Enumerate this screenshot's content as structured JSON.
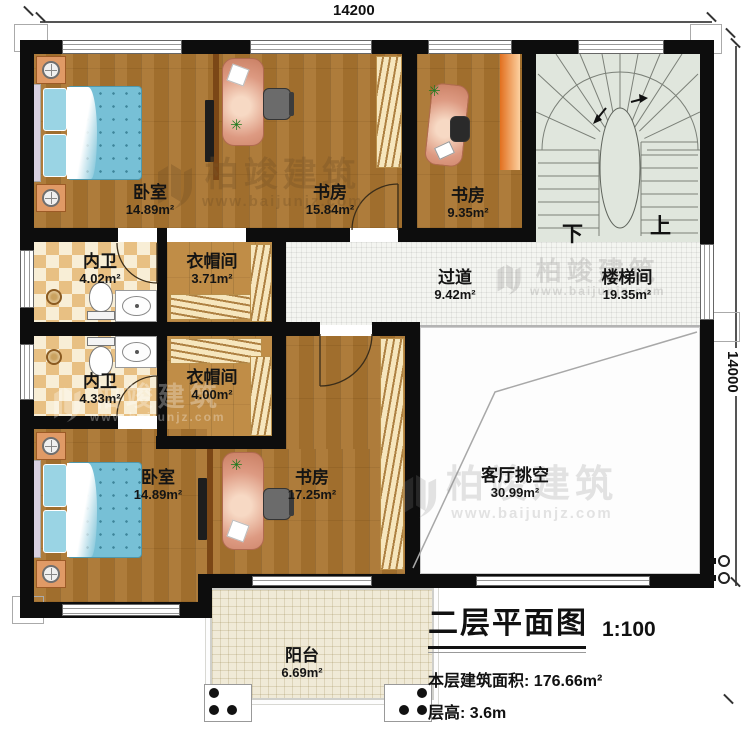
{
  "dimensions": {
    "top": "14200",
    "right": "14000"
  },
  "rooms": [
    {
      "name": "卧室",
      "area": "14.89m²"
    },
    {
      "name": "书房",
      "area": "15.84m²"
    },
    {
      "name": "书房",
      "area": "9.35m²"
    },
    {
      "name": "楼梯间",
      "area": "19.35m²"
    },
    {
      "name": "内卫",
      "area": "4.02m²"
    },
    {
      "name": "衣帽间",
      "area": "3.71m²"
    },
    {
      "name": "过道",
      "area": "9.42m²"
    },
    {
      "name": "内卫",
      "area": "4.33m²"
    },
    {
      "name": "衣帽间",
      "area": "4.00m²"
    },
    {
      "name": "卧室",
      "area": "14.89m²"
    },
    {
      "name": "书房",
      "area": "17.25m²"
    },
    {
      "name": "客厅挑空",
      "area": "30.99m²"
    },
    {
      "name": "阳台",
      "area": "6.69m²"
    }
  ],
  "stairs": {
    "down": "下",
    "up": "上"
  },
  "watermark": {
    "brand": "柏竣建筑",
    "url": "www.baijunjz.com"
  },
  "title_block": {
    "title": "二层平面图",
    "scale": "1:100",
    "area_label": "本层建筑面积:",
    "area_value": "176.66m²",
    "height_label": "层高:",
    "height_value": "3.6m"
  },
  "colors": {
    "wall": "#0d0d0d",
    "wood": "#a9742f",
    "tile": "#f4f5f1",
    "stair_floor": "#e0e6dd",
    "desk": "#dd9a82",
    "bed": "#77c0d6"
  }
}
